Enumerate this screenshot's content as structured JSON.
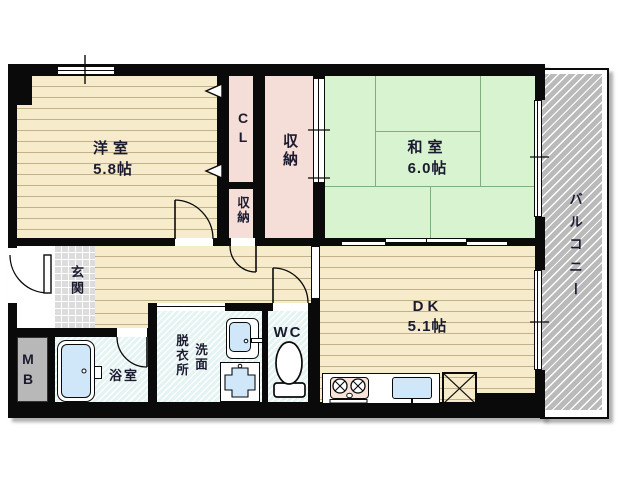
{
  "rooms": {
    "yoshitsu": {
      "label": "洋室",
      "size": "5.8帖"
    },
    "washitsu": {
      "label": "和室",
      "size": "6.0帖"
    },
    "dk": {
      "label": "DK",
      "size": "5.1帖"
    },
    "cl": {
      "label": "CL"
    },
    "closet_upper": {
      "label": "収納"
    },
    "closet_lower": {
      "label": "収納"
    },
    "genkan": {
      "label": "玄関"
    },
    "mb": {
      "label": "MB"
    },
    "bath": {
      "label": "浴室"
    },
    "dressing": {
      "label": "脱衣所"
    },
    "washstand": {
      "label": "洗面"
    },
    "wc": {
      "label": "WC"
    },
    "balcony": {
      "label": "バルコニー"
    }
  },
  "colors": {
    "wall": "#0a0a0a",
    "wood": "#f6ebcb",
    "wood-line": "#c2b089",
    "tatami": "#d8f3d0",
    "tatami-line": "#7fae7f",
    "closet-pink": "#f5ddd8",
    "wet": "#e4f4f2",
    "tile": "#dcdcdc",
    "balcony-gray": "#bababa",
    "mb-gray": "#b8b8b8",
    "fixture-blue": "#cfe7f8",
    "stove-pink": "#f8e3d9",
    "text": "#1b1b30"
  }
}
